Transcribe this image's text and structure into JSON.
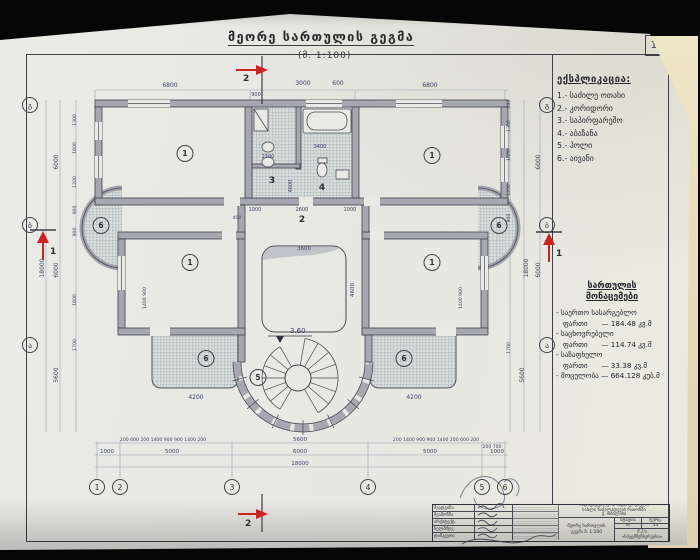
{
  "page": {
    "number": "13"
  },
  "title": {
    "text": "მეორე სართულის გეგმა",
    "scale": "(მ. 1:100)"
  },
  "legend": {
    "header": "ექსპლიკაცია:",
    "items": [
      "1.- საძილე ოთახი",
      "2.- კორიდორი",
      "3.- საპირფარეშო",
      "4.- აბაზანა",
      "5.- ჰოლი",
      "6.- აივანი"
    ]
  },
  "areas": {
    "header_line1": "სართულის",
    "header_line2": "მონაცემები",
    "lines": [
      "- საერთო სასარგებლო",
      "   ფართი      — 184.48 კვ.მ",
      "- საცხოვრებელი",
      "   ფართი      — 114.74 კვ.მ",
      "- საზაფხულო",
      "   ფართი      — 33.38 კვ.მ",
      "- მოცულობა — 664.128 კუბ.მ"
    ]
  },
  "plan": {
    "level": "3.60",
    "sections": {
      "top": "2",
      "bottom": "2",
      "left": "1",
      "right": "1"
    },
    "axes_bottom": [
      "1",
      "2",
      "3",
      "4",
      "5",
      "6"
    ],
    "axes_side": [
      "გ",
      "ბ",
      "ა"
    ],
    "rooms": [
      "1",
      "1",
      "3",
      "4",
      "2",
      "1",
      "1",
      "6",
      "6",
      "6",
      "6",
      "5"
    ],
    "dims": [
      "6800",
      "3000",
      "600",
      "6800",
      "900",
      "200 600 200 1400 900 900 1400 200",
      "5600",
      "200 1400 900 900 1400 200 600 200",
      "200 700",
      "1000",
      "5000",
      "6000",
      "5000",
      "1000",
      "18000",
      "6000",
      "6000",
      "5600",
      "18000",
      "1300",
      "1800",
      "1200",
      "900",
      "900",
      "1800",
      "1700",
      "6000",
      "6000",
      "5600",
      "18000",
      "1300",
      "1800",
      "1200",
      "900",
      "1700",
      "200",
      "2300",
      "3400",
      "4600",
      "1000",
      "2600",
      "1000",
      "400",
      "3600",
      "4600",
      "1400 900",
      "1400 900",
      "4200",
      "4200"
    ]
  },
  "title_block": {
    "roles": [
      "შეადგინა",
      "შეამოწმა",
      "არქიტექტ.",
      "ხელმძღვ.",
      "დამკვეთი"
    ],
    "project_lines": [
      "ინდივიდუალური საცხოვრებელი",
      "სახლი ნაძალადევის რაიონში",
      "ქ. თბილისი"
    ],
    "drawing_line1": "მეორე სართულის",
    "drawing_line2": "გეგმა  მ. 1:100",
    "stage_label": "სტადია",
    "sheet_label": "ფურც.",
    "stage_value": "მპ",
    "sheet_value": "13",
    "company_line1": "შ.პ.ს",
    "company_line2": "«სპეცმშენსერვისი»"
  }
}
